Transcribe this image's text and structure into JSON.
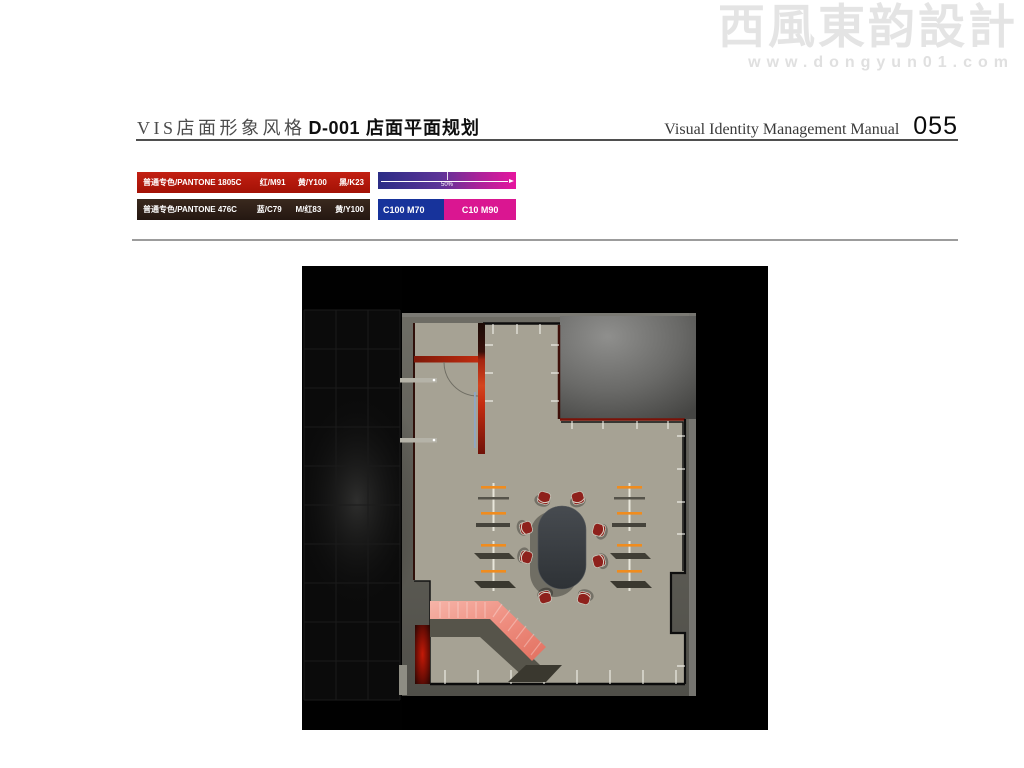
{
  "watermark": {
    "logo_text": "西風東韵設計",
    "website": "www.dongyun01.com"
  },
  "header": {
    "series_label": "VIS店面形象风格",
    "item_code": "D-001",
    "item_title": "店面平面规划",
    "manual_name": "Visual Identity Management Manual",
    "page_number": "055"
  },
  "color_specs": {
    "swatches": [
      {
        "label": "普通专色/PANTONE 1805C",
        "values": [
          "红/M91",
          "黄/Y100",
          "黑/K23"
        ],
        "hex": "#b6190d"
      },
      {
        "label": "普通专色/PANTONE 476C",
        "values": [
          "蓝/C79",
          "M/红83",
          "黄/Y100"
        ],
        "hex": "#2f2118"
      }
    ],
    "gradient_bar": {
      "marker_label": "50%",
      "start_hex": "#2b2d86",
      "end_hex": "#e6169e"
    },
    "split_bar": {
      "left_label": "C100 M70",
      "right_label": "C10 M90",
      "left_hex": "#17339b",
      "right_hex": "#da1691"
    }
  },
  "floor_plan": {
    "panel_background": "#000000",
    "wall_hex": "#64635b",
    "floor_tile_hex": "#a6a294",
    "feature_wall_red_hex": "#c5290e",
    "fixture_accent_orange_hex": "#f08c1e",
    "table_hex": "#383c40",
    "chair_red_hex": "#8e211c",
    "ramp_pink_hex": "#ee8d7f"
  }
}
